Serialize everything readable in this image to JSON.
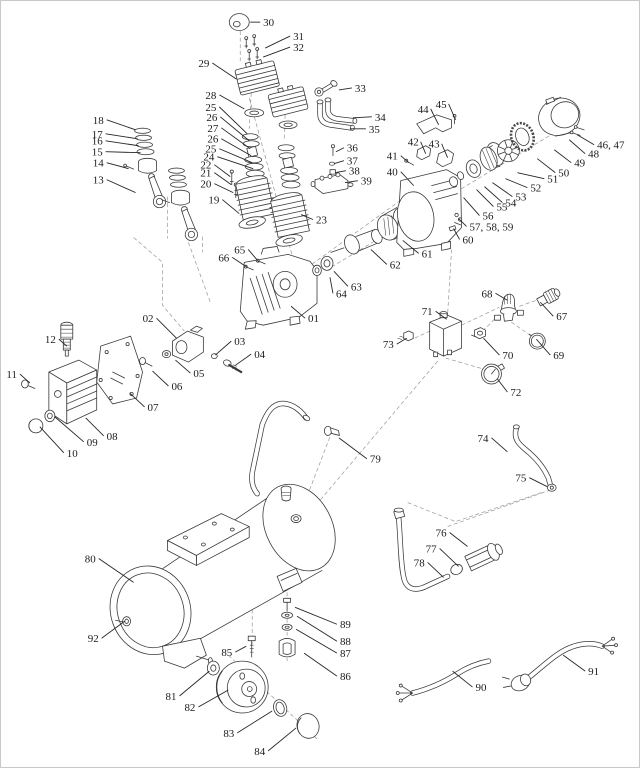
{
  "figure": {
    "width": 640,
    "height": 768,
    "background": "#ffffff",
    "border_color": "#c8c8c8"
  },
  "style": {
    "line_color": "#3a3a3a",
    "dash_color": "#979797",
    "leader_color": "#262626",
    "label_color": "#1c1c1c",
    "label_font_size": 11
  },
  "diagram": {
    "type": "exploded-parts-diagram",
    "subject": "air-compressor",
    "part_labels": [
      {
        "text": "01",
        "anchor": "start",
        "x": 308,
        "y": 322,
        "line": [
          305,
          318,
          291,
          306
        ]
      },
      {
        "text": "02",
        "anchor": "end",
        "x": 153,
        "y": 322,
        "line": [
          156,
          318,
          176,
          338
        ]
      },
      {
        "text": "03",
        "anchor": "start",
        "x": 234,
        "y": 345,
        "line": [
          231,
          341,
          215,
          355
        ]
      },
      {
        "text": "04",
        "anchor": "start",
        "x": 254,
        "y": 358,
        "line": [
          251,
          354,
          234,
          366
        ]
      },
      {
        "text": "05",
        "anchor": "start",
        "x": 193,
        "y": 377,
        "line": [
          190,
          373,
          175,
          360
        ]
      },
      {
        "text": "06",
        "anchor": "start",
        "x": 171,
        "y": 390,
        "line": [
          168,
          386,
          152,
          371
        ]
      },
      {
        "text": "07",
        "anchor": "start",
        "x": 147,
        "y": 411,
        "line": [
          144,
          407,
          129,
          393
        ]
      },
      {
        "text": "08",
        "anchor": "start",
        "x": 106,
        "y": 440,
        "line": [
          103,
          436,
          85,
          418
        ]
      },
      {
        "text": "09",
        "anchor": "start",
        "x": 86,
        "y": 446,
        "line": [
          83,
          442,
          54,
          417
        ]
      },
      {
        "text": "10",
        "anchor": "start",
        "x": 66,
        "y": 457,
        "line": [
          63,
          453,
          39,
          427
        ]
      },
      {
        "text": "11",
        "anchor": "end",
        "x": 16,
        "y": 378,
        "line": [
          19,
          374,
          29,
          383
        ]
      },
      {
        "text": "12",
        "anchor": "end",
        "x": 55,
        "y": 343,
        "line": [
          58,
          339,
          66,
          346
        ]
      },
      {
        "text": "13",
        "anchor": "end",
        "x": 103,
        "y": 183,
        "line": [
          106,
          179,
          135,
          192
        ]
      },
      {
        "text": "14",
        "anchor": "end",
        "x": 103,
        "y": 166,
        "line": [
          106,
          162,
          128,
          168
        ]
      },
      {
        "text": "15",
        "anchor": "end",
        "x": 102,
        "y": 155,
        "line": [
          105,
          151,
          140,
          152
        ]
      },
      {
        "text": "16",
        "anchor": "end",
        "x": 102,
        "y": 144,
        "line": [
          105,
          140,
          138,
          145
        ]
      },
      {
        "text": "17",
        "anchor": "end",
        "x": 102,
        "y": 137,
        "line": [
          105,
          133,
          137,
          138
        ]
      },
      {
        "text": "18",
        "anchor": "end",
        "x": 103,
        "y": 123,
        "line": [
          106,
          119,
          135,
          129
        ]
      },
      {
        "text": "19",
        "anchor": "end",
        "x": 219,
        "y": 203,
        "line": [
          222,
          199,
          239,
          213
        ]
      },
      {
        "text": "20",
        "anchor": "end",
        "x": 211,
        "y": 187,
        "line": [
          214,
          183,
          233,
          192
        ]
      },
      {
        "text": "21",
        "anchor": "end",
        "x": 211,
        "y": 176,
        "line": [
          214,
          172,
          231,
          184
        ]
      },
      {
        "text": "22",
        "anchor": "end",
        "x": 211,
        "y": 168,
        "line": [
          214,
          164,
          230,
          176
        ]
      },
      {
        "text": "23",
        "anchor": "start",
        "x": 316,
        "y": 223,
        "line": [
          313,
          219,
          301,
          214
        ]
      },
      {
        "text": "24",
        "anchor": "end",
        "x": 214,
        "y": 160,
        "line": [
          217,
          156,
          253,
          168
        ]
      },
      {
        "text": "25",
        "anchor": "end",
        "x": 216,
        "y": 110,
        "line": [
          219,
          106,
          247,
          133
        ]
      },
      {
        "text": "26",
        "anchor": "end",
        "x": 217,
        "y": 120,
        "line": [
          220,
          116,
          249,
          140
        ]
      },
      {
        "text": "27",
        "anchor": "end",
        "x": 218,
        "y": 131,
        "line": [
          221,
          127,
          250,
          148
        ]
      },
      {
        "text": "26",
        "anchor": "end",
        "x": 218,
        "y": 142,
        "line": [
          221,
          138,
          251,
          155
        ]
      },
      {
        "text": "25",
        "anchor": "end",
        "x": 216,
        "y": 152,
        "line": [
          219,
          148,
          252,
          162
        ]
      },
      {
        "text": "28",
        "anchor": "end",
        "x": 216,
        "y": 98,
        "line": [
          219,
          94,
          244,
          108
        ]
      },
      {
        "text": "29",
        "anchor": "end",
        "x": 209,
        "y": 66,
        "line": [
          212,
          62,
          236,
          78
        ]
      },
      {
        "text": "30",
        "anchor": "start",
        "x": 263,
        "y": 25,
        "line": [
          260,
          21,
          250,
          21
        ]
      },
      {
        "text": "31",
        "anchor": "start",
        "x": 293,
        "y": 39,
        "line": [
          290,
          35,
          265,
          47
        ]
      },
      {
        "text": "32",
        "anchor": "start",
        "x": 293,
        "y": 50,
        "line": [
          290,
          46,
          263,
          56
        ]
      },
      {
        "text": "33",
        "anchor": "start",
        "x": 355,
        "y": 91,
        "line": [
          352,
          87,
          339,
          89
        ]
      },
      {
        "text": "34",
        "anchor": "start",
        "x": 375,
        "y": 120,
        "line": [
          372,
          116,
          353,
          117
        ]
      },
      {
        "text": "35",
        "anchor": "start",
        "x": 369,
        "y": 132,
        "line": [
          366,
          128,
          350,
          128
        ]
      },
      {
        "text": "36",
        "anchor": "start",
        "x": 347,
        "y": 151,
        "line": [
          344,
          147,
          336,
          151
        ]
      },
      {
        "text": "37",
        "anchor": "start",
        "x": 347,
        "y": 164,
        "line": [
          344,
          160,
          334,
          163
        ]
      },
      {
        "text": "38",
        "anchor": "start",
        "x": 349,
        "y": 174,
        "line": [
          346,
          170,
          335,
          172
        ]
      },
      {
        "text": "39",
        "anchor": "start",
        "x": 361,
        "y": 184,
        "line": [
          358,
          180,
          345,
          182
        ]
      },
      {
        "text": "40",
        "anchor": "end",
        "x": 398,
        "y": 175,
        "line": [
          401,
          171,
          414,
          185
        ]
      },
      {
        "text": "41",
        "anchor": "end",
        "x": 398,
        "y": 159,
        "line": [
          401,
          155,
          409,
          162
        ]
      },
      {
        "text": "42",
        "anchor": "end",
        "x": 419,
        "y": 145,
        "line": [
          421,
          141,
          426,
          153
        ]
      },
      {
        "text": "43",
        "anchor": "end",
        "x": 440,
        "y": 147,
        "line": [
          442,
          143,
          448,
          157
        ]
      },
      {
        "text": "44",
        "anchor": "end",
        "x": 429,
        "y": 112,
        "line": [
          431,
          108,
          439,
          124
        ]
      },
      {
        "text": "45",
        "anchor": "end",
        "x": 447,
        "y": 107,
        "line": [
          449,
          103,
          456,
          119
        ]
      },
      {
        "text": "46, 47",
        "anchor": "start",
        "x": 598,
        "y": 148,
        "line": [
          595,
          144,
          578,
          134
        ]
      },
      {
        "text": "48",
        "anchor": "start",
        "x": 589,
        "y": 157,
        "line": [
          586,
          153,
          570,
          139
        ]
      },
      {
        "text": "49",
        "anchor": "start",
        "x": 575,
        "y": 166,
        "line": [
          572,
          162,
          555,
          149
        ]
      },
      {
        "text": "50",
        "anchor": "start",
        "x": 559,
        "y": 176,
        "line": [
          556,
          172,
          538,
          158
        ]
      },
      {
        "text": "51",
        "anchor": "start",
        "x": 548,
        "y": 182,
        "line": [
          545,
          178,
          518,
          172
        ]
      },
      {
        "text": "52",
        "anchor": "start",
        "x": 531,
        "y": 191,
        "line": [
          528,
          187,
          506,
          178
        ]
      },
      {
        "text": "53",
        "anchor": "start",
        "x": 516,
        "y": 200,
        "line": [
          513,
          196,
          493,
          182
        ]
      },
      {
        "text": "54",
        "anchor": "start",
        "x": 506,
        "y": 206,
        "line": [
          503,
          202,
          485,
          186
        ]
      },
      {
        "text": "55",
        "anchor": "start",
        "x": 497,
        "y": 210,
        "line": [
          494,
          206,
          477,
          189
        ]
      },
      {
        "text": "56",
        "anchor": "start",
        "x": 483,
        "y": 219,
        "line": [
          480,
          215,
          464,
          197
        ]
      },
      {
        "text": "57, 58, 59",
        "anchor": "start",
        "x": 470,
        "y": 230,
        "line": [
          467,
          226,
          459,
          218
        ]
      },
      {
        "text": "60",
        "anchor": "start",
        "x": 463,
        "y": 243,
        "line": [
          460,
          239,
          454,
          228
        ]
      },
      {
        "text": "61",
        "anchor": "start",
        "x": 422,
        "y": 257,
        "line": [
          419,
          253,
          403,
          240
        ]
      },
      {
        "text": "62",
        "anchor": "start",
        "x": 390,
        "y": 268,
        "line": [
          387,
          264,
          371,
          249
        ]
      },
      {
        "text": "63",
        "anchor": "start",
        "x": 351,
        "y": 290,
        "line": [
          348,
          286,
          334,
          271
        ]
      },
      {
        "text": "64",
        "anchor": "start",
        "x": 336,
        "y": 297,
        "line": [
          333,
          293,
          330,
          277
        ]
      },
      {
        "text": "65",
        "anchor": "end",
        "x": 245,
        "y": 253,
        "line": [
          248,
          249,
          259,
          262
        ]
      },
      {
        "text": "66",
        "anchor": "end",
        "x": 229,
        "y": 261,
        "line": [
          232,
          257,
          247,
          267
        ]
      },
      {
        "text": "67",
        "anchor": "start",
        "x": 557,
        "y": 320,
        "line": [
          554,
          316,
          541,
          302
        ]
      },
      {
        "text": "68",
        "anchor": "end",
        "x": 493,
        "y": 297,
        "line": [
          496,
          293,
          508,
          300
        ]
      },
      {
        "text": "69",
        "anchor": "start",
        "x": 554,
        "y": 359,
        "line": [
          551,
          355,
          537,
          339
        ]
      },
      {
        "text": "70",
        "anchor": "start",
        "x": 503,
        "y": 359,
        "line": [
          500,
          355,
          484,
          338
        ]
      },
      {
        "text": "71",
        "anchor": "end",
        "x": 433,
        "y": 315,
        "line": [
          436,
          311,
          447,
          319
        ]
      },
      {
        "text": "72",
        "anchor": "start",
        "x": 511,
        "y": 396,
        "line": [
          508,
          392,
          498,
          379
        ]
      },
      {
        "text": "73",
        "anchor": "end",
        "x": 394,
        "y": 348,
        "line": [
          397,
          344,
          407,
          338
        ]
      },
      {
        "text": "74",
        "anchor": "end",
        "x": 489,
        "y": 442,
        "line": [
          492,
          438,
          508,
          452
        ]
      },
      {
        "text": "75",
        "anchor": "end",
        "x": 527,
        "y": 482,
        "line": [
          530,
          478,
          548,
          487
        ]
      },
      {
        "text": "76",
        "anchor": "end",
        "x": 447,
        "y": 537,
        "line": [
          450,
          533,
          468,
          547
        ]
      },
      {
        "text": "77",
        "anchor": "end",
        "x": 437,
        "y": 553,
        "line": [
          440,
          549,
          459,
          567
        ]
      },
      {
        "text": "78",
        "anchor": "end",
        "x": 425,
        "y": 567,
        "line": [
          428,
          563,
          444,
          578
        ]
      },
      {
        "text": "79",
        "anchor": "start",
        "x": 370,
        "y": 463,
        "line": [
          367,
          459,
          339,
          438
        ]
      },
      {
        "text": "80",
        "anchor": "end",
        "x": 95,
        "y": 563,
        "line": [
          98,
          559,
          133,
          583
        ]
      },
      {
        "text": "81",
        "anchor": "end",
        "x": 176,
        "y": 701,
        "line": [
          179,
          697,
          209,
          672
        ]
      },
      {
        "text": "82",
        "anchor": "end",
        "x": 195,
        "y": 712,
        "line": [
          198,
          708,
          228,
          691
        ]
      },
      {
        "text": "83",
        "anchor": "end",
        "x": 234,
        "y": 738,
        "line": [
          237,
          734,
          272,
          712
        ]
      },
      {
        "text": "84",
        "anchor": "end",
        "x": 265,
        "y": 756,
        "line": [
          268,
          752,
          296,
          729
        ]
      },
      {
        "text": "85",
        "anchor": "end",
        "x": 232,
        "y": 657,
        "line": [
          235,
          653,
          246,
          647
        ]
      },
      {
        "text": "86",
        "anchor": "start",
        "x": 340,
        "y": 681,
        "line": [
          337,
          677,
          304,
          654
        ]
      },
      {
        "text": "87",
        "anchor": "start",
        "x": 340,
        "y": 658,
        "line": [
          337,
          654,
          296,
          630
        ]
      },
      {
        "text": "88",
        "anchor": "start",
        "x": 340,
        "y": 646,
        "line": [
          337,
          642,
          297,
          617
        ]
      },
      {
        "text": "89",
        "anchor": "start",
        "x": 340,
        "y": 629,
        "line": [
          337,
          625,
          295,
          608
        ]
      },
      {
        "text": "90",
        "anchor": "start",
        "x": 476,
        "y": 692,
        "line": [
          473,
          688,
          453,
          672
        ]
      },
      {
        "text": "91",
        "anchor": "start",
        "x": 589,
        "y": 676,
        "line": [
          586,
          672,
          564,
          656
        ]
      },
      {
        "text": "92",
        "anchor": "end",
        "x": 98,
        "y": 643,
        "line": [
          101,
          639,
          124,
          622
        ]
      }
    ]
  }
}
